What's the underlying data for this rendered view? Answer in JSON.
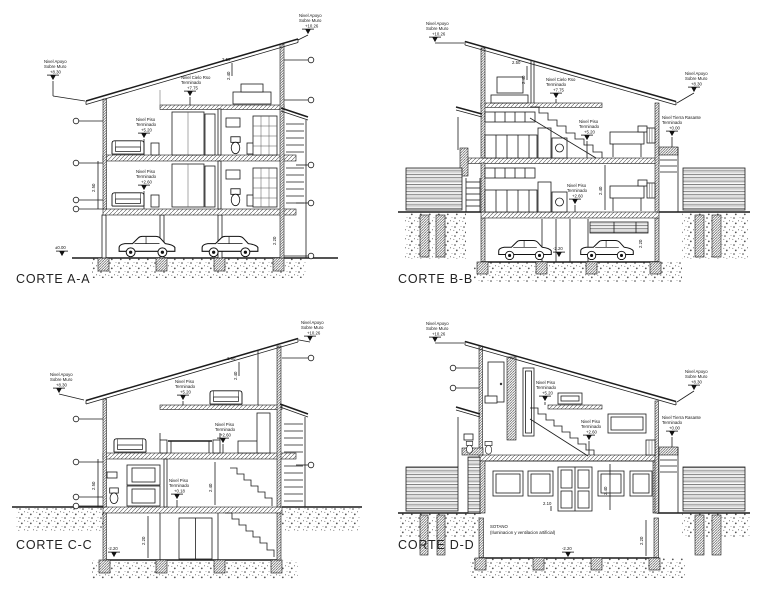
{
  "drawing": {
    "ink": "#1c1c1c",
    "paper": "#ffffff",
    "labels": {
      "nivel_apoyo_l1": "Nivel Apoyo",
      "nivel_apoyo_l2": "Sobre Muro",
      "nivel_piso_l1": "Nivel Piso",
      "nivel_piso_l2": "Terminado",
      "nivel_cielo_l1": "Nivel Cielo Rso",
      "nivel_cielo_l2": "Terminado",
      "nivel_tierra_l1": "Nivel Tierra Rasante",
      "nivel_tierra_l2": "Terminado"
    },
    "dims": {
      "roof_run": "2.50",
      "rafter_h": "2.40",
      "floor_h": "2.50",
      "room_h": "2.40",
      "basement_h": "2.20",
      "parking_h": "2.20",
      "door_h": "2.10"
    },
    "sections": {
      "a": {
        "title": "CORTE A-A",
        "apoyo_left": "+8.30",
        "apoyo_right": "+10.26",
        "cielo": "+7.75",
        "piso_upper": "+5.20",
        "piso_lower": "+2.60",
        "ground": "±0.00"
      },
      "b": {
        "title": "CORTE B-B",
        "apoyo_left": "+10.26",
        "apoyo_right": "+8.30",
        "cielo": "+7.75",
        "piso_upper": "+5.20",
        "piso_lower": "+2.60",
        "tierra": "+0.00",
        "basement": "-2.20"
      },
      "c": {
        "title": "CORTE C-C",
        "apoyo_left": "+8.30",
        "apoyo_right": "+10.26",
        "piso_attic": "+5.20",
        "piso_mid": "+2.60",
        "piso_lower": "+0.18",
        "basement": "-2.20"
      },
      "d": {
        "title": "CORTE D-D",
        "apoyo_left": "+10.26",
        "apoyo_right": "+8.30",
        "piso_upper": "+5.20",
        "piso_mid": "+2.60",
        "tierra": "+0.00",
        "basement": "-2.20",
        "sotano_l1": "SOTANO",
        "sotano_l2": "(Iluminacion y ventilacion artificial)"
      }
    }
  }
}
